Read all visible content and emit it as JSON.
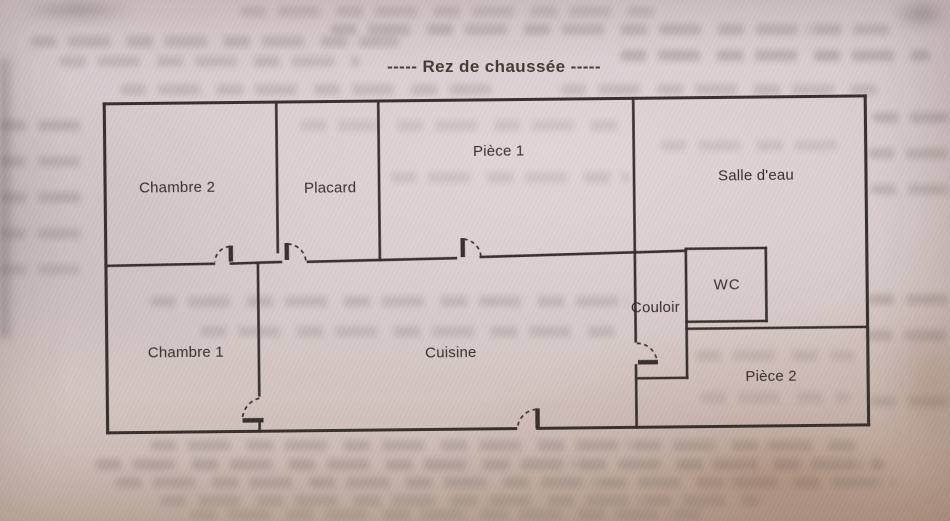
{
  "title": "-----  Rez de chaussée  -----",
  "floor_plan": {
    "rooms": [
      {
        "id": "chambre2",
        "label": "Chambre 2"
      },
      {
        "id": "placard",
        "label": "Placard"
      },
      {
        "id": "piece1",
        "label": "Pièce 1"
      },
      {
        "id": "salle_deau",
        "label": "Salle d'eau"
      },
      {
        "id": "wc",
        "label": "WC"
      },
      {
        "id": "couloir",
        "label": "Couloir"
      },
      {
        "id": "chambre1",
        "label": "Chambre 1"
      },
      {
        "id": "cuisine",
        "label": "Cuisine"
      },
      {
        "id": "piece2",
        "label": "Pièce 2"
      }
    ],
    "colors": {
      "ink": "#352e2b",
      "paper": "#d6c9cb",
      "corner_shadow": "#b28868"
    }
  }
}
